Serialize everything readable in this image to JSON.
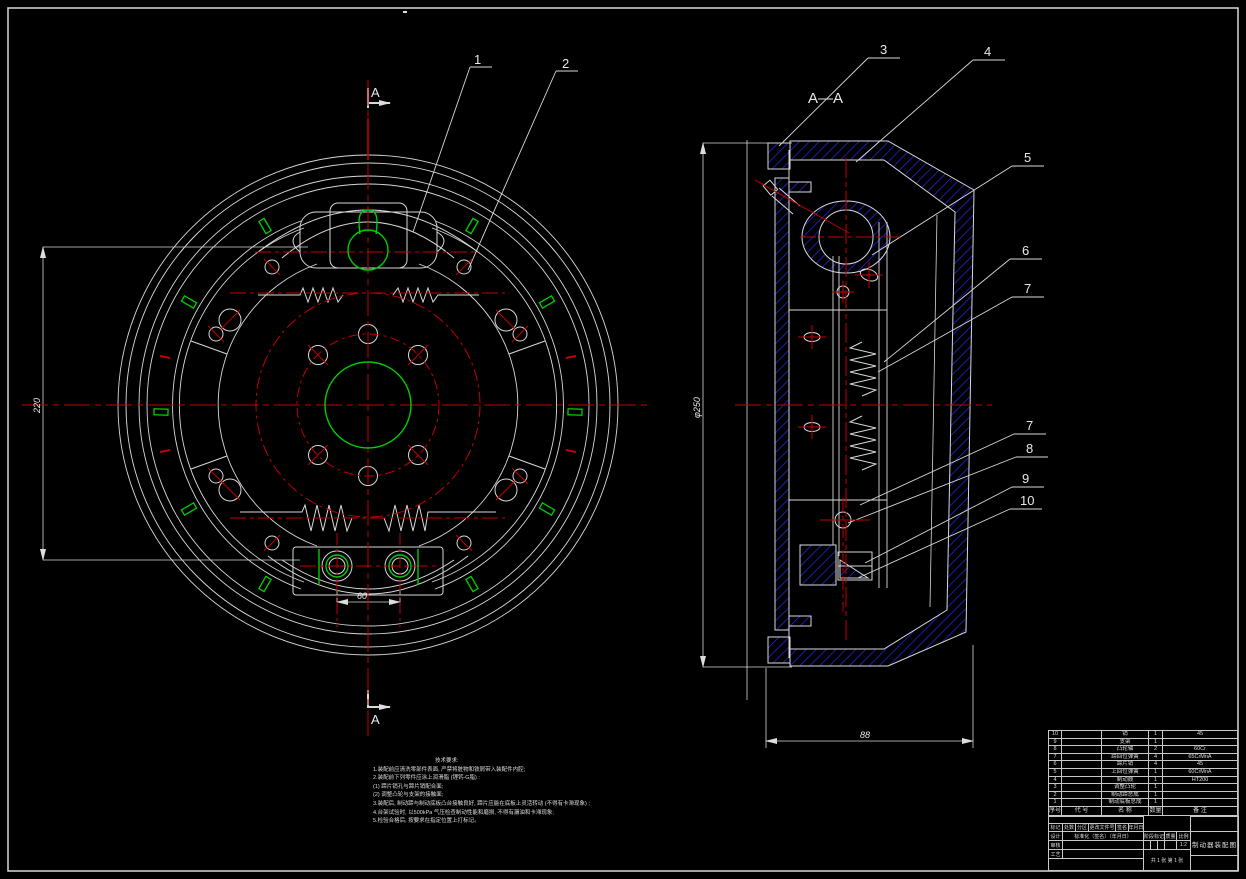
{
  "drawing": {
    "section_view_title": "A—A",
    "section_mark": "A",
    "top_mark": "·",
    "balloons": {
      "b1": "1",
      "b2": "2",
      "b3": "3",
      "b4": "4",
      "b5": "5",
      "b6": "6",
      "b7": "7",
      "b8": "8",
      "b9": "9",
      "b10": "10"
    },
    "dimensions": {
      "shoe_span": "220",
      "anchor_pin_spacing": "60",
      "drum_diameter": "φ250",
      "drum_depth": "88"
    },
    "notes": {
      "title": "技术要求:",
      "lines": [
        "1.装配前应清洗零部件表面, 严禁将脏物和铁屑带入装配件内腔;",
        "2.装配前下列零件应涂上润滑脂 (锂钙-G脂) :",
        "(1) 蹄片销孔与蹄片销配合面;",
        "(2) 调整凸轮与支架的接触面;",
        "3.装配后, 制动蹄与制动底板凸台接触良好, 蹄片应能在底板上灵活转动 (不得有卡滞现象) ;",
        "4.台架试验时, 以500kPa 气压检查制动性能和磨损, 不得有漏油和卡滞现象;",
        "5.检验合格后, 按要求在指定位置上打标记。"
      ]
    }
  },
  "parts_list": {
    "headers": {
      "no": "序号",
      "code": "代 号",
      "name": "名 称",
      "qty": "数量",
      "remark": "备 注"
    },
    "rows": [
      {
        "no": "10",
        "code": "",
        "name": "销",
        "qty": "1",
        "remark": "45"
      },
      {
        "no": "9",
        "code": "",
        "name": "支架",
        "qty": "1",
        "remark": ""
      },
      {
        "no": "8",
        "code": "",
        "name": "凸轮轴",
        "qty": "2",
        "remark": "60Cr"
      },
      {
        "no": "7",
        "code": "",
        "name": "蹄回位弹簧",
        "qty": "4",
        "remark": "65CrMnA"
      },
      {
        "no": "6",
        "code": "",
        "name": "蹄片销",
        "qty": "4",
        "remark": "45"
      },
      {
        "no": "5",
        "code": "",
        "name": "上回位弹簧",
        "qty": "1",
        "remark": "60CrMnA"
      },
      {
        "no": "4",
        "code": "",
        "name": "制动鼓",
        "qty": "1",
        "remark": "HT200"
      },
      {
        "no": "3",
        "code": "",
        "name": "调整凸轮",
        "qty": "1",
        "remark": ""
      },
      {
        "no": "2",
        "code": "",
        "name": "制动蹄总成",
        "qty": "1",
        "remark": ""
      },
      {
        "no": "1",
        "code": "",
        "name": "制动底板总成",
        "qty": "1",
        "remark": ""
      }
    ]
  },
  "title_block": {
    "rev_headers": [
      "标记",
      "处数",
      "分区",
      "更改文件号",
      "签名",
      "年月日"
    ],
    "design": "设计",
    "check": "审核",
    "process": "工艺",
    "standard": "标准化（签名）（年月日）",
    "stage": "阶段标记",
    "weight": "质量",
    "scale": "比例",
    "scale_value": "1:2",
    "sheet": "共 1 张  第 1 张",
    "title": "制动器装配图"
  }
}
